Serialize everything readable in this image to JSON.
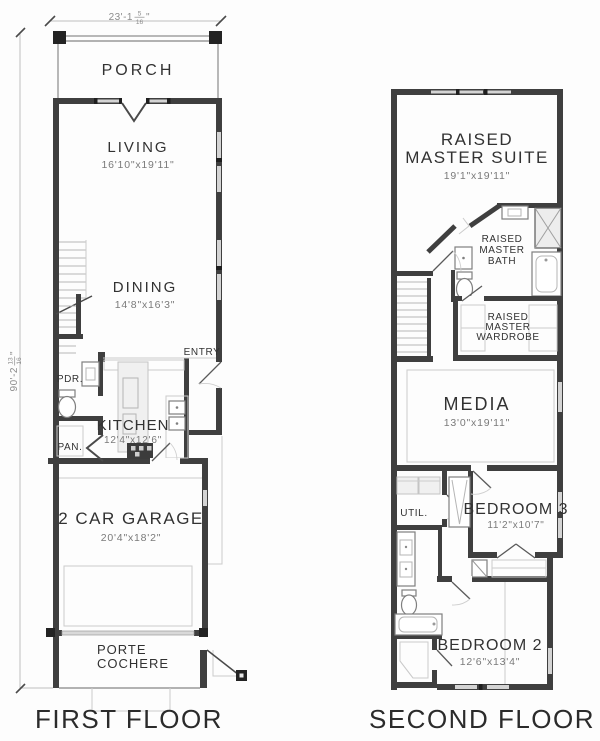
{
  "drawing": {
    "background": "#fdfdfd",
    "wall_color": "#3f3f3f",
    "light_line_color": "#cbcbcb",
    "text_color": "#323232"
  },
  "dimensions": {
    "width": {
      "main": "23'-1",
      "numerator": "5",
      "denominator": "16",
      "unit": "\""
    },
    "height": {
      "main": "90'-2",
      "numerator": "13",
      "denominator": "16",
      "unit": "\""
    }
  },
  "first_floor": {
    "title": "FIRST FLOOR",
    "porch": "PORCH",
    "living": "LIVING",
    "living_size": "16'10\"x19'11\"",
    "dining": "DINING",
    "dining_size": "14'8\"x16'3\"",
    "entry": "ENTRY",
    "powder": "PDR.",
    "pantry": "PAN.",
    "kitchen": "KITCHEN",
    "kitchen_size": "12'4\"x12'6\"",
    "garage": "2 CAR GARAGE",
    "garage_size": "20'4\"x18'2\"",
    "porte_line1": "PORTE",
    "porte_line2": "COCHERE"
  },
  "second_floor": {
    "title": "SECOND FLOOR",
    "suite_line1": "RAISED",
    "suite_line2": "MASTER SUITE",
    "suite_size": "19'1\"x19'11\"",
    "bath_line1": "RAISED",
    "bath_line2": "MASTER",
    "bath_line3": "BATH",
    "wardrobe_line1": "RAISED",
    "wardrobe_line2": "MASTER",
    "wardrobe_line3": "WARDROBE",
    "media": "MEDIA",
    "media_size": "13'0\"x19'11\"",
    "utility": "UTIL.",
    "bedroom3": "BEDROOM 3",
    "bedroom3_size": "11'2\"x10'7\"",
    "bedroom2": "BEDROOM 2",
    "bedroom2_size": "12'6\"x13'4\""
  }
}
